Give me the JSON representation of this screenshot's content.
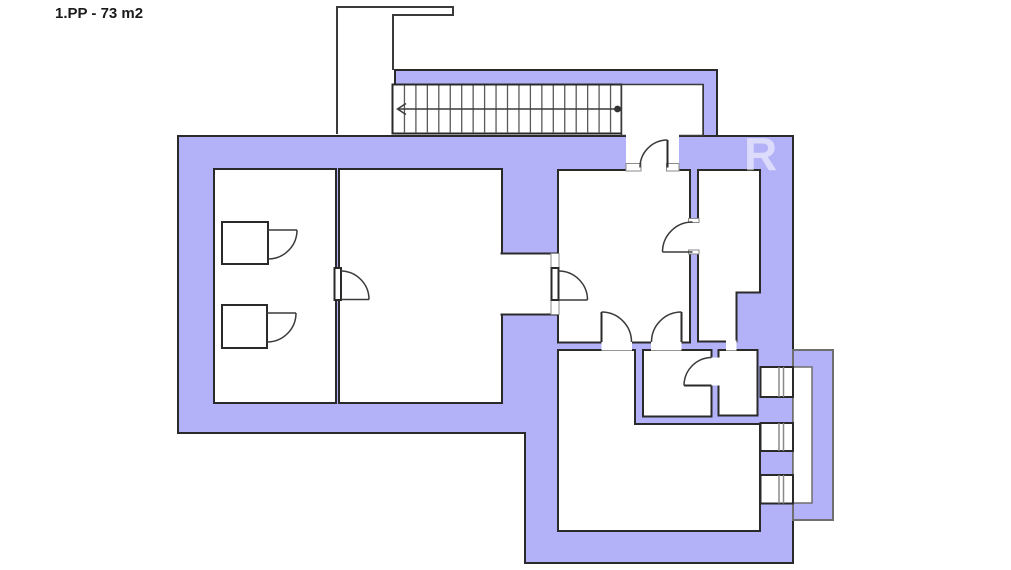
{
  "floor_plan": {
    "label": "1.PP - 73 m2",
    "watermark_letter": "R",
    "colors": {
      "wall_fill": "#b3b1f7",
      "outline": "#2a2a2a",
      "inner_line": "#3a3a3a",
      "tread_line": "#5a5a5a",
      "bay_outline": "#6f6f6f",
      "sill_outline": "#8a8a8a",
      "room_fill": "#ffffff",
      "watermark_fill": "#ffffff"
    },
    "stairs": {
      "tread_count": 20,
      "direction": "left"
    },
    "summary": {
      "rooms": 7,
      "doors": 8,
      "windows": 3,
      "fixtures": 2
    }
  }
}
